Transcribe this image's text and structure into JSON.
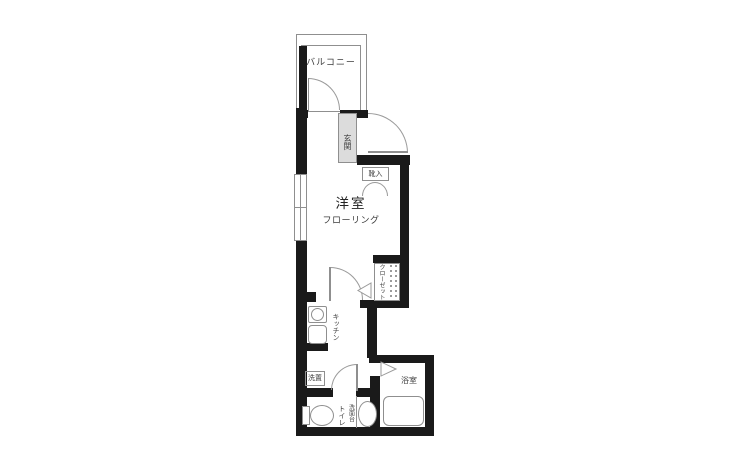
{
  "floorplan": {
    "labels": {
      "balcony": "バルコニー",
      "entrance": "玄関",
      "shoe_cabinet": "靴入",
      "western_room": "洋室",
      "western_room_floor": "フローリング",
      "closet": "クローゼット",
      "kitchen": "キッチン",
      "washer_space": "洗置",
      "toilet": "トイレ",
      "washstand": "洗面台",
      "bathroom": "浴室"
    },
    "colors": {
      "wall": "#1a1a1a",
      "line": "#8f8f8f",
      "entrance_fill": "#dcdcdc",
      "text": "#3c3c3c",
      "background": "#ffffff"
    }
  }
}
